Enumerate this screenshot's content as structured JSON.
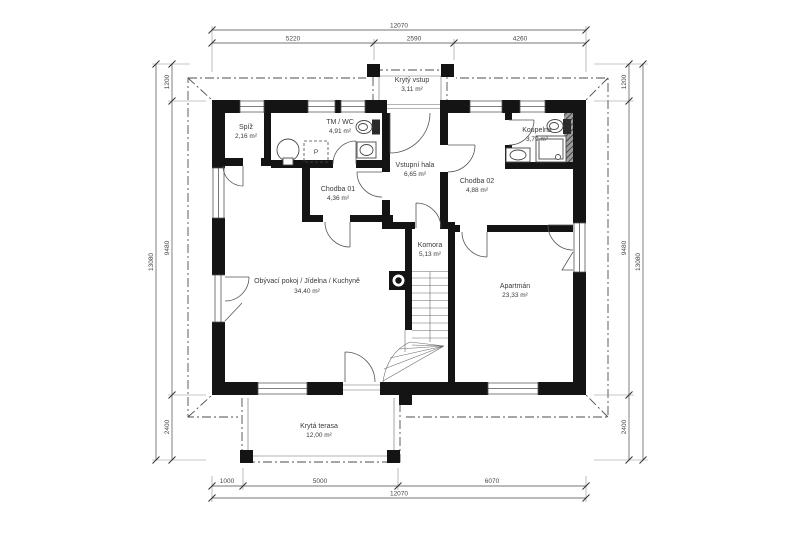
{
  "rooms": {
    "krytyVstup": {
      "name": "Krytý vstup",
      "area": "3,11 m²"
    },
    "spiz": {
      "name": "Spíž",
      "area": "2,16 m²"
    },
    "tmwc": {
      "name": "TM / WC",
      "area": "4,91 m²"
    },
    "chodba01": {
      "name": "Chodba 01",
      "area": "4,36 m²"
    },
    "vstupniHala": {
      "name": "Vstupní hala",
      "area": "6,65 m²"
    },
    "chodba02": {
      "name": "Chodba 02",
      "area": "4,88 m²"
    },
    "koupelna": {
      "name": "Koupelna",
      "area": "3,79 m²"
    },
    "komora": {
      "name": "Komora",
      "area": "5,13 m²"
    },
    "obyvaciPokoj": {
      "name": "Obývací pokoj / Jídelna / Kuchyně",
      "area": "34,40 m²"
    },
    "apartman": {
      "name": "Apartmán",
      "area": "23,33 m²"
    },
    "krytaTerasa": {
      "name": "Krytá terasa",
      "area": "12,00 m²"
    }
  },
  "appliances": {
    "washer": "P"
  },
  "dimensions": {
    "top": {
      "overall": "12070",
      "segments": [
        "5220",
        "2590",
        "4260"
      ]
    },
    "bottom": {
      "overall": "12070",
      "segments": [
        "1000",
        "5000",
        "6070"
      ]
    },
    "left": {
      "overall": "13080",
      "segments": [
        "1200",
        "9480",
        "2400"
      ]
    },
    "right": {
      "overall": "13080",
      "segments": [
        "1200",
        "9480",
        "2400"
      ]
    }
  },
  "colors": {
    "wall": "#141414",
    "line": "#565656",
    "background": "#ffffff"
  }
}
